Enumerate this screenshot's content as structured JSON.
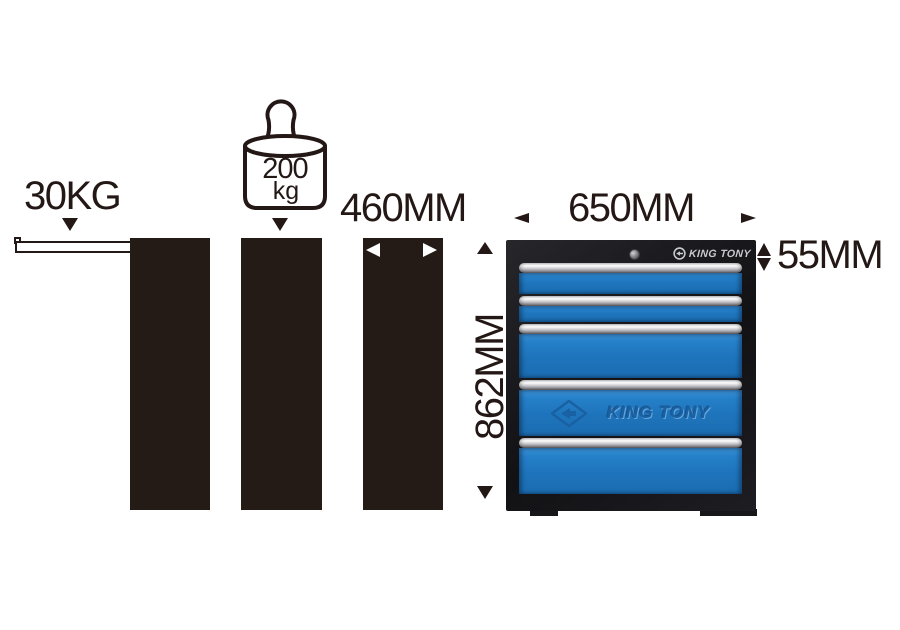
{
  "colors": {
    "ink": "#231815",
    "drawer_blue": "#1e74bb",
    "cabinet_black": "#18181b",
    "handle_silver": "#cbcbd0",
    "badge_text_gray": "#c9cacd",
    "emboss_blue": "#1a61a4"
  },
  "annotations": {
    "drawer_load": {
      "label": "30KG"
    },
    "total_load": {
      "value": "200",
      "unit": "kg"
    },
    "depth": {
      "label": "460MM"
    },
    "width": {
      "label": "650MM"
    },
    "height": {
      "label": "862MM"
    },
    "drawer_front_height": {
      "label": "55MM"
    }
  },
  "cabinet": {
    "brand_badge": "KING TONY",
    "emboss_logo_text": "KING TONY",
    "drawer_count": 5,
    "drawers": [
      {
        "height_px": 31,
        "embossed": false
      },
      {
        "height_px": 26,
        "embossed": false
      },
      {
        "height_px": 54,
        "embossed": false
      },
      {
        "height_px": 56,
        "embossed": true
      },
      {
        "height_px": 56,
        "embossed": false
      }
    ]
  }
}
